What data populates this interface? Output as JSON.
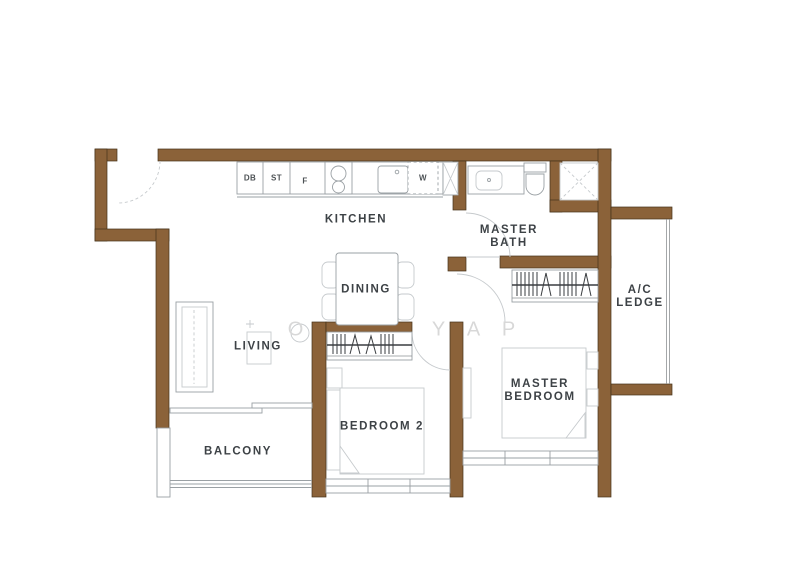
{
  "rooms": {
    "kitchen": {
      "label": "KITCHEN"
    },
    "master_bath": {
      "line1": "MASTER",
      "line2": "BATH"
    },
    "dining": {
      "label": "DINING"
    },
    "living": {
      "label": "LIVING"
    },
    "ac_ledge": {
      "line1": "A/C",
      "line2": "LEDGE"
    },
    "master_bedroom": {
      "line1": "MASTER",
      "line2": "BEDROOM"
    },
    "bedroom2": {
      "label": "BEDROOM 2"
    },
    "balcony": {
      "label": "BALCONY"
    }
  },
  "fixtures": {
    "db": "DB",
    "st": "ST",
    "fridge": "F",
    "washer": "W"
  },
  "watermark": {
    "letters": [
      "O",
      "Y",
      "A",
      "P"
    ]
  },
  "colors": {
    "wall": "#8b6239",
    "wall_edge": "#45321a",
    "line": "#9aa0a4",
    "line_light": "#c6cacd",
    "dark": "#3a3d40",
    "label": "#3d4246",
    "watermark": "#d8d8d8"
  }
}
